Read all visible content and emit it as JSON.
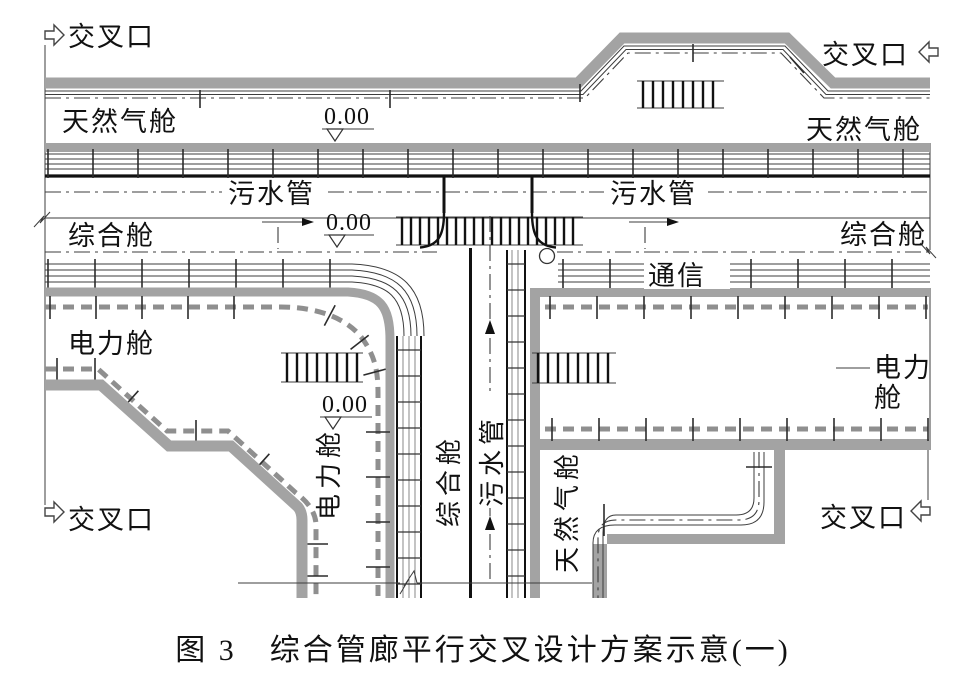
{
  "diagram": {
    "caption": "图 3　综合管廊平行交叉设计方案示意(一)",
    "labels": {
      "intersection": "交叉口",
      "gas_compartment": "天然气舱",
      "sewage_pipe": "污水管",
      "utility_compartment": "综合舱",
      "power_compartment": "电力舱",
      "power_compartment_line1": "电力",
      "power_compartment_line2": "舱",
      "communication": "通信",
      "elevation_zero": "0.00"
    },
    "colors": {
      "wall_gray": "#a3a3a3",
      "cable_gray": "#8f8f8f",
      "line_dark": "#3c3c3c",
      "background": "#ffffff"
    }
  }
}
